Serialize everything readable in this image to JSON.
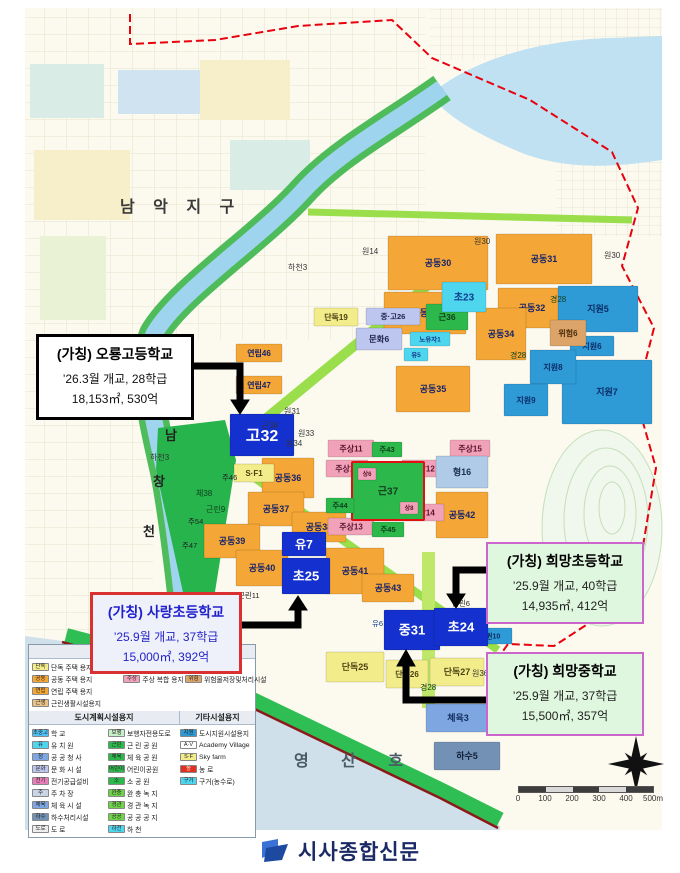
{
  "map": {
    "parcel_styles": {
      "or": {
        "bg": "#F4A636",
        "fg": "#17246B"
      },
      "ye": {
        "bg": "#F3EC8A",
        "fg": "#4A4210"
      },
      "pk": {
        "bg": "#F2A2B8",
        "fg": "#5A1430"
      },
      "gn": {
        "bg": "#2DB84C",
        "fg": "#0E3D1C"
      },
      "gnb": {
        "bg": "#2DB84C",
        "fg": "#123D1C",
        "stroke": "#E01010"
      },
      "lv": {
        "bg": "#BCC6EE",
        "fg": "#22264E"
      },
      "cy": {
        "bg": "#4FD6EF",
        "fg": "#123C8C"
      },
      "lb": {
        "bg": "#AFCBE8",
        "fg": "#1D3050"
      },
      "bl": {
        "bg": "#2E9BD6",
        "fg": "#0B2B66"
      },
      "tn": {
        "bg": "#DCA469",
        "fg": "#4A2B08"
      },
      "sb": {
        "bg": "#7EA6E0",
        "fg": "#122B5E"
      },
      "sb2": {
        "bg": "#7291B5",
        "fg": "#122039"
      },
      "sch": {
        "bg": "#1430CE",
        "fg": "#FFFFFF"
      }
    },
    "parcels": [
      {
        "l": "공동30",
        "x": 388,
        "y": 236,
        "w": 100,
        "h": 54,
        "c": "or"
      },
      {
        "l": "공동31",
        "x": 496,
        "y": 234,
        "w": 96,
        "h": 50,
        "c": "or"
      },
      {
        "l": "공동32",
        "x": 498,
        "y": 288,
        "w": 68,
        "h": 40,
        "c": "or"
      },
      {
        "l": "공동33",
        "x": 384,
        "y": 292,
        "w": 82,
        "h": 42,
        "c": "or"
      },
      {
        "l": "공동34",
        "x": 476,
        "y": 308,
        "w": 50,
        "h": 52,
        "c": "or"
      },
      {
        "l": "공동35",
        "x": 396,
        "y": 366,
        "w": 74,
        "h": 46,
        "c": "or"
      },
      {
        "l": "공동36",
        "x": 262,
        "y": 458,
        "w": 52,
        "h": 40,
        "c": "or"
      },
      {
        "l": "공동37",
        "x": 248,
        "y": 492,
        "w": 56,
        "h": 34,
        "c": "or"
      },
      {
        "l": "공동38",
        "x": 292,
        "y": 512,
        "w": 54,
        "h": 30,
        "c": "or"
      },
      {
        "l": "공동39",
        "x": 204,
        "y": 524,
        "w": 56,
        "h": 34,
        "c": "or"
      },
      {
        "l": "공동40",
        "x": 236,
        "y": 550,
        "w": 52,
        "h": 36,
        "c": "or"
      },
      {
        "l": "공동41",
        "x": 326,
        "y": 548,
        "w": 58,
        "h": 46,
        "c": "or"
      },
      {
        "l": "공동42",
        "x": 436,
        "y": 492,
        "w": 52,
        "h": 46,
        "c": "or"
      },
      {
        "l": "공동43",
        "x": 362,
        "y": 574,
        "w": 52,
        "h": 28,
        "c": "or"
      },
      {
        "l": "연립46",
        "x": 236,
        "y": 344,
        "w": 46,
        "h": 18,
        "c": "or",
        "fs": 8
      },
      {
        "l": "연립47",
        "x": 236,
        "y": 376,
        "w": 46,
        "h": 18,
        "c": "or",
        "fs": 8
      },
      {
        "l": "단독19",
        "x": 314,
        "y": 308,
        "w": 44,
        "h": 18,
        "c": "ye",
        "fs": 8
      },
      {
        "l": "단독25",
        "x": 326,
        "y": 652,
        "w": 58,
        "h": 30,
        "c": "ye"
      },
      {
        "l": "단독26",
        "x": 386,
        "y": 660,
        "w": 42,
        "h": 28,
        "c": "ye",
        "fs": 8
      },
      {
        "l": "단독27",
        "x": 430,
        "y": 658,
        "w": 54,
        "h": 28,
        "c": "ye"
      },
      {
        "l": "S·F1",
        "x": 234,
        "y": 464,
        "w": 40,
        "h": 18,
        "c": "ye",
        "fs": 8
      },
      {
        "l": "주상11",
        "x": 328,
        "y": 440,
        "w": 46,
        "h": 17,
        "c": "pk",
        "fs": 8
      },
      {
        "l": "주상10",
        "x": 326,
        "y": 460,
        "w": 42,
        "h": 17,
        "c": "pk",
        "fs": 8
      },
      {
        "l": "주상12",
        "x": 402,
        "y": 460,
        "w": 42,
        "h": 17,
        "c": "pk",
        "fs": 8
      },
      {
        "l": "주상14",
        "x": 402,
        "y": 504,
        "w": 42,
        "h": 17,
        "c": "pk",
        "fs": 8
      },
      {
        "l": "주상13",
        "x": 328,
        "y": 518,
        "w": 46,
        "h": 17,
        "c": "pk",
        "fs": 8
      },
      {
        "l": "주상15",
        "x": 450,
        "y": 440,
        "w": 40,
        "h": 17,
        "c": "pk",
        "fs": 8
      },
      {
        "l": "근37",
        "x": 352,
        "y": 462,
        "w": 72,
        "h": 58,
        "c": "gnb",
        "fs": 10
      },
      {
        "l": "상6",
        "x": 358,
        "y": 468,
        "w": 18,
        "h": 12,
        "c": "pk",
        "fs": 6
      },
      {
        "l": "상8",
        "x": 400,
        "y": 502,
        "w": 18,
        "h": 12,
        "c": "pk",
        "fs": 6
      },
      {
        "l": "주43",
        "x": 372,
        "y": 442,
        "w": 30,
        "h": 15,
        "c": "gn",
        "fs": 7.5
      },
      {
        "l": "주44",
        "x": 326,
        "y": 498,
        "w": 28,
        "h": 15,
        "c": "gn",
        "fs": 7.5
      },
      {
        "l": "주45",
        "x": 372,
        "y": 522,
        "w": 32,
        "h": 15,
        "c": "gn",
        "fs": 7.5
      },
      {
        "l": "문화6",
        "x": 356,
        "y": 328,
        "w": 46,
        "h": 22,
        "c": "lv",
        "fs": 8.5
      },
      {
        "l": "중·고26",
        "x": 366,
        "y": 308,
        "w": 54,
        "h": 17,
        "c": "lv",
        "fs": 7.5
      },
      {
        "l": "근36",
        "x": 426,
        "y": 304,
        "w": 42,
        "h": 26,
        "c": "gn",
        "fs": 8.5
      },
      {
        "l": "초23",
        "x": 442,
        "y": 282,
        "w": 44,
        "h": 30,
        "c": "cy",
        "fs": 10
      },
      {
        "l": "노유자1",
        "x": 410,
        "y": 332,
        "w": 40,
        "h": 14,
        "c": "cy",
        "fs": 6.5
      },
      {
        "l": "유5",
        "x": 404,
        "y": 348,
        "w": 24,
        "h": 13,
        "c": "cy",
        "fs": 6.5
      },
      {
        "l": "형16",
        "x": 436,
        "y": 456,
        "w": 52,
        "h": 32,
        "c": "lb",
        "fs": 9
      },
      {
        "l": "지원5",
        "x": 558,
        "y": 286,
        "w": 80,
        "h": 46,
        "c": "bl"
      },
      {
        "l": "지원6",
        "x": 570,
        "y": 336,
        "w": 44,
        "h": 20,
        "c": "bl",
        "fs": 8
      },
      {
        "l": "지원7",
        "x": 562,
        "y": 360,
        "w": 90,
        "h": 64,
        "c": "bl"
      },
      {
        "l": "지원8",
        "x": 530,
        "y": 350,
        "w": 46,
        "h": 34,
        "c": "bl",
        "fs": 8
      },
      {
        "l": "지원9",
        "x": 504,
        "y": 384,
        "w": 44,
        "h": 32,
        "c": "bl",
        "fs": 8
      },
      {
        "l": "지원10",
        "x": 468,
        "y": 628,
        "w": 44,
        "h": 16,
        "c": "bl",
        "fs": 7
      },
      {
        "l": "위험6",
        "x": 550,
        "y": 320,
        "w": 36,
        "h": 26,
        "c": "tn",
        "fs": 8
      },
      {
        "l": "체육3",
        "x": 426,
        "y": 704,
        "w": 64,
        "h": 28,
        "c": "sb"
      },
      {
        "l": "하수5",
        "x": 434,
        "y": 742,
        "w": 66,
        "h": 28,
        "c": "sb2"
      },
      {
        "l": "고32",
        "x": 230,
        "y": 414,
        "w": 64,
        "h": 42,
        "c": "sch",
        "fs": 16
      },
      {
        "l": "유7",
        "x": 282,
        "y": 532,
        "w": 44,
        "h": 24,
        "c": "sch",
        "fs": 12
      },
      {
        "l": "초25",
        "x": 282,
        "y": 558,
        "w": 48,
        "h": 36,
        "c": "sch",
        "fs": 13
      },
      {
        "l": "중31",
        "x": 384,
        "y": 610,
        "w": 56,
        "h": 40,
        "c": "sch",
        "fs": 13
      },
      {
        "l": "초24",
        "x": 434,
        "y": 608,
        "w": 54,
        "h": 38,
        "c": "sch",
        "fs": 13
      }
    ],
    "labels": [
      {
        "t": "남 악 지 구",
        "x": 120,
        "y": 212,
        "fs": 16,
        "col": "#3A3A3A",
        "ls": 7,
        "b": true
      },
      {
        "t": "영 산 호",
        "x": 294,
        "y": 766,
        "fs": 16,
        "col": "#4A5A66",
        "ls": 14,
        "b": true
      },
      {
        "t": "남",
        "x": 165,
        "y": 440,
        "fs": 13,
        "col": "#222",
        "b": true
      },
      {
        "t": "창",
        "x": 153,
        "y": 486,
        "fs": 13,
        "col": "#222",
        "b": true
      },
      {
        "t": "천",
        "x": 143,
        "y": 536,
        "fs": 13,
        "col": "#222",
        "b": true
      },
      {
        "t": "하천3",
        "x": 288,
        "y": 270,
        "fs": 8,
        "col": "#333"
      },
      {
        "t": "하천3",
        "x": 150,
        "y": 460,
        "fs": 8,
        "col": "#333"
      },
      {
        "t": "체38",
        "x": 196,
        "y": 496,
        "fs": 8,
        "col": "#0E3D1C"
      },
      {
        "t": "근린9",
        "x": 206,
        "y": 512,
        "fs": 8,
        "col": "#0E3D1C"
      },
      {
        "t": "주46",
        "x": 222,
        "y": 480,
        "fs": 7.5,
        "col": "#222"
      },
      {
        "t": "주54",
        "x": 188,
        "y": 524,
        "fs": 7.5,
        "col": "#222"
      },
      {
        "t": "주47",
        "x": 182,
        "y": 548,
        "fs": 7.5,
        "col": "#222"
      },
      {
        "t": "근린11",
        "x": 238,
        "y": 598,
        "fs": 7.5,
        "col": "#222"
      },
      {
        "t": "근린6",
        "x": 452,
        "y": 606,
        "fs": 7.5,
        "col": "#222"
      },
      {
        "t": "유6",
        "x": 372,
        "y": 626,
        "fs": 7.5,
        "col": "#123C8C"
      },
      {
        "t": "원14",
        "x": 362,
        "y": 254,
        "fs": 8,
        "col": "#333"
      },
      {
        "t": "원30",
        "x": 474,
        "y": 244,
        "fs": 8,
        "col": "#333"
      },
      {
        "t": "원30",
        "x": 604,
        "y": 258,
        "fs": 8,
        "col": "#333"
      },
      {
        "t": "원31",
        "x": 284,
        "y": 414,
        "fs": 8,
        "col": "#333"
      },
      {
        "t": "원33",
        "x": 298,
        "y": 436,
        "fs": 8,
        "col": "#333"
      },
      {
        "t": "근34",
        "x": 262,
        "y": 428,
        "fs": 8,
        "col": "#333"
      },
      {
        "t": "원34",
        "x": 286,
        "y": 446,
        "fs": 8,
        "col": "#333"
      },
      {
        "t": "경28",
        "x": 550,
        "y": 302,
        "fs": 8,
        "col": "#0E3D1C"
      },
      {
        "t": "경28",
        "x": 510,
        "y": 358,
        "fs": 8,
        "col": "#0E3D1C"
      },
      {
        "t": "경28",
        "x": 420,
        "y": 690,
        "fs": 8,
        "col": "#0E3D1C"
      },
      {
        "t": "원36",
        "x": 472,
        "y": 676,
        "fs": 8,
        "col": "#333"
      }
    ]
  },
  "callouts": [
    {
      "title": "(가칭) 오룡고등학교",
      "line1": "’26.3월 개교, 28학급",
      "line2": "18,153㎡, 530억"
    },
    {
      "title": "(가칭) 사랑초등학교",
      "line1": "’25.9월 개교, 37학급",
      "line2": "15,000㎡, 392억"
    },
    {
      "title": "(가칭) 희망초등학교",
      "line1": "’25.9월 개교, 40학급",
      "line2": "14,935㎡, 412억"
    },
    {
      "title": "(가칭) 희망중학교",
      "line1": "’25.9월 개교, 37학급",
      "line2": "15,500㎡, 357억"
    }
  ],
  "legend": {
    "housing": {
      "title": "주택건설용지",
      "cols": [
        [
          {
            "b": "단독",
            "c": "#F3EC8A",
            "t": "단독 주택 용지"
          },
          {
            "b": "공동",
            "c": "#F4A636",
            "t": "공동 주택 용지"
          },
          {
            "b": "연립",
            "c": "#F4A636",
            "t": "연립 주택 용지"
          },
          {
            "b": "근생",
            "c": "#E8C188",
            "t": "근린생활시설용지"
          }
        ],
        [
          {
            "b": "준",
            "c": "#F4A636",
            "t": "준주거 용지"
          },
          {
            "b": "주상",
            "c": "#F2A2B8",
            "t": "주상 복합 용지"
          }
        ],
        [
          {
            "b": "노유자",
            "c": "#4FD6EF",
            "t": "노유자시설"
          },
          {
            "b": "위험",
            "c": "#DCA469",
            "t": "위험물저장및처리시설"
          }
        ]
      ]
    },
    "planning": {
      "title": "도시계획시설용지",
      "cols": [
        [
          {
            "b": "초중고",
            "c": "#4FC3F7",
            "t": "학  교"
          },
          {
            "b": "유",
            "c": "#4FD6EF",
            "t": "유 치 원"
          },
          {
            "b": "청",
            "c": "#7EA6E0",
            "t": "공 공 청 사"
          },
          {
            "b": "문화",
            "c": "#BCC6EE",
            "t": "문 화 시 설"
          },
          {
            "b": "전기",
            "c": "#E87FB8",
            "t": "전기공급설비"
          },
          {
            "b": "주",
            "c": "#C9D4E4",
            "t": "주 차 장"
          },
          {
            "b": "체육",
            "c": "#7EA6E0",
            "t": "체 육 시 설"
          },
          {
            "b": "하수",
            "c": "#7291B5",
            "t": "하수처리시설"
          },
          {
            "b": "도로",
            "c": "#EDEDED",
            "t": "도  로"
          }
        ],
        [
          {
            "b": "보행",
            "c": "#C8F0C8",
            "t": "보행자전용도로"
          },
          {
            "b": "근린",
            "c": "#2DB84C",
            "t": "근 린 공 원"
          },
          {
            "b": "체육",
            "c": "#2DB84C",
            "t": "체 육 공 원"
          },
          {
            "b": "어린이",
            "c": "#2DB84C",
            "t": "어린이공원"
          },
          {
            "b": "소",
            "c": "#2DB84C",
            "t": "소 공 원"
          },
          {
            "b": "완충",
            "c": "#6FD24A",
            "t": "완 충 녹 지"
          },
          {
            "b": "경관",
            "c": "#6FD24A",
            "t": "경 관 녹 지"
          },
          {
            "b": "공공",
            "c": "#6FD24A",
            "t": "공 공 공 지"
          },
          {
            "b": "하천",
            "c": "#4FD6EF",
            "t": "하 천"
          }
        ]
      ]
    },
    "etc": {
      "title": "기타시설용지",
      "items": [
        {
          "b": "지원",
          "c": "#2E9BD6",
          "t": "도시지원시설용지"
        },
        {
          "b": "A·V",
          "c": "#FFFFFF",
          "t": "Academy Village"
        },
        {
          "b": "S·F",
          "c": "#F3EC8A",
          "t": "Sky farm"
        },
        {
          "b": "농",
          "c": "#E03020",
          "bf": "#ffffff",
          "t": "농  로"
        },
        {
          "b": "구거",
          "c": "#4FD6EF",
          "t": "구거(농수로)"
        }
      ]
    }
  },
  "scalebar": {
    "labels": [
      "0",
      "100",
      "200",
      "300",
      "400",
      "500m"
    ]
  },
  "footer": {
    "logo_text": "시사종합신문"
  }
}
